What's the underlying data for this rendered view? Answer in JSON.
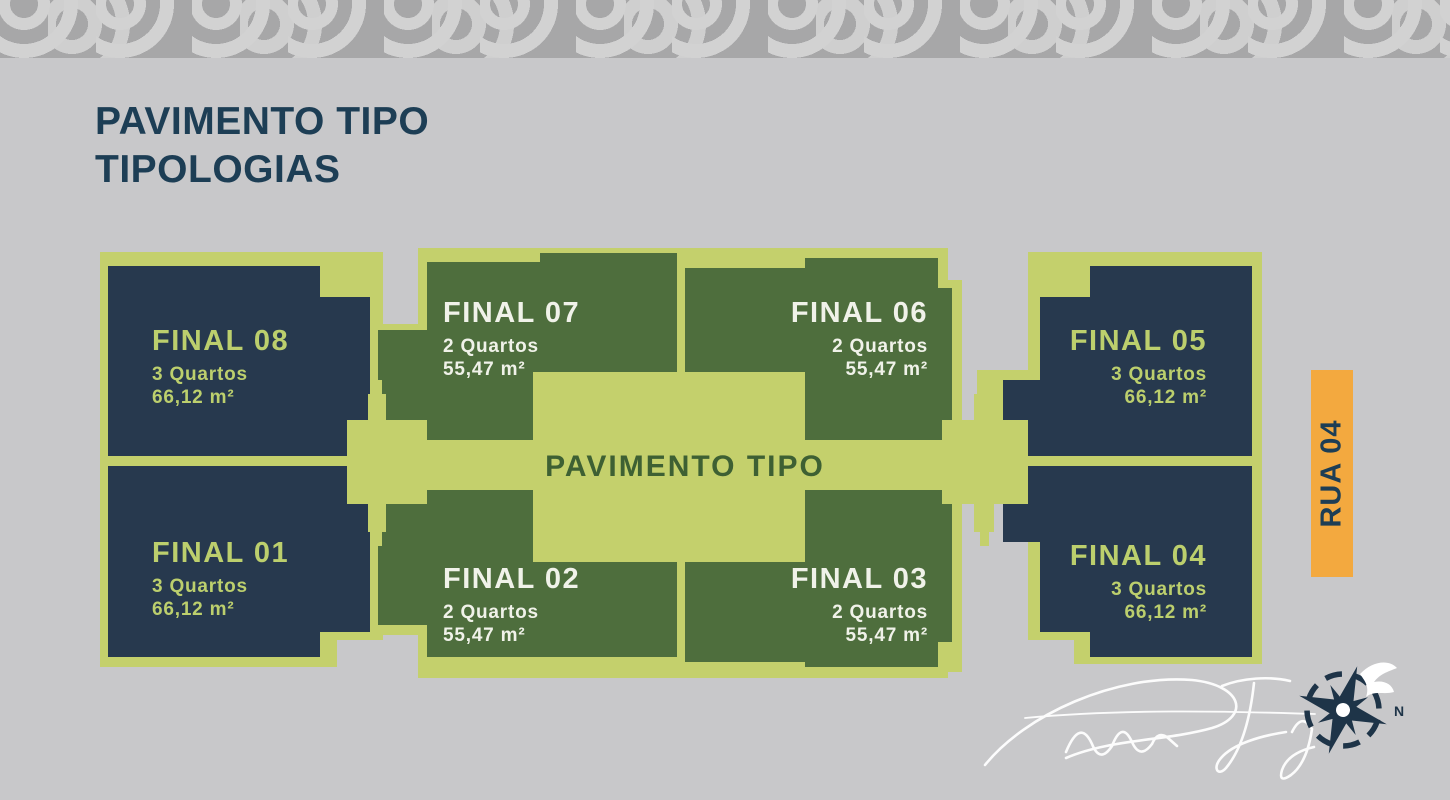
{
  "title": {
    "line1": "PAVIMENTO TIPO",
    "line2": "TIPOLOGIAS",
    "color": "#1d3e55"
  },
  "plan": {
    "label": "PAVIMENTO TIPO",
    "colors": {
      "plate": "#c4d06c",
      "navy_block": "#27394e",
      "green_block": "#4e6e3d",
      "navy_block_text": "#bccf6d",
      "green_block_text": "#f0f2e9",
      "corridor_label_text": "#3e6033"
    },
    "units": [
      {
        "id": "final-08",
        "name": "FINAL 08",
        "rooms": "3 Quartos",
        "area": "66,12 m²"
      },
      {
        "id": "final-07",
        "name": "FINAL 07",
        "rooms": "2 Quartos",
        "area": "55,47 m²"
      },
      {
        "id": "final-06",
        "name": "FINAL 06",
        "rooms": "2 Quartos",
        "area": "55,47 m²"
      },
      {
        "id": "final-05",
        "name": "FINAL 05",
        "rooms": "3 Quartos",
        "area": "66,12 m²"
      },
      {
        "id": "final-01",
        "name": "FINAL 01",
        "rooms": "3 Quartos",
        "area": "66,12 m²"
      },
      {
        "id": "final-02",
        "name": "FINAL 02",
        "rooms": "2 Quartos",
        "area": "55,47 m²"
      },
      {
        "id": "final-03",
        "name": "FINAL 03",
        "rooms": "2 Quartos",
        "area": "55,47 m²"
      },
      {
        "id": "final-04",
        "name": "FINAL 04",
        "rooms": "3 Quartos",
        "area": "66,12 m²"
      }
    ]
  },
  "street_label": {
    "text": "RUA 04",
    "bg": "#f3a93f"
  },
  "signature": {
    "name": "Rodrigo Taguary",
    "compass_n": "N"
  }
}
